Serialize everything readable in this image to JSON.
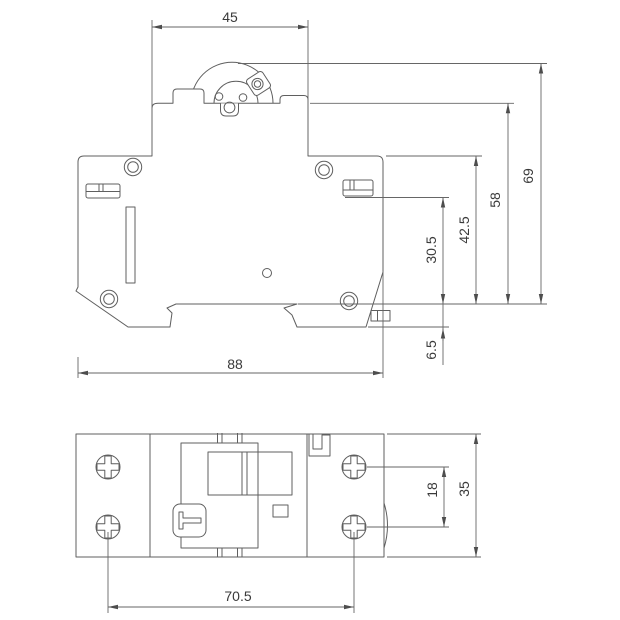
{
  "canvas": {
    "background": "#ffffff",
    "line_color": "#5f5f5f",
    "text_color": "#3a3a3a"
  },
  "side_view": {
    "dim_top_width": "45",
    "dim_total_height": "69",
    "dim_body_height": "58",
    "dim_upper_body_height": "42.5",
    "dim_terminal_height": "30.5",
    "dim_clip_depth": "6.5",
    "dim_overall_width": "88"
  },
  "plan_view": {
    "dim_screw_span": "70.5",
    "dim_screw_spacing": "18",
    "dim_body_depth": "35"
  }
}
